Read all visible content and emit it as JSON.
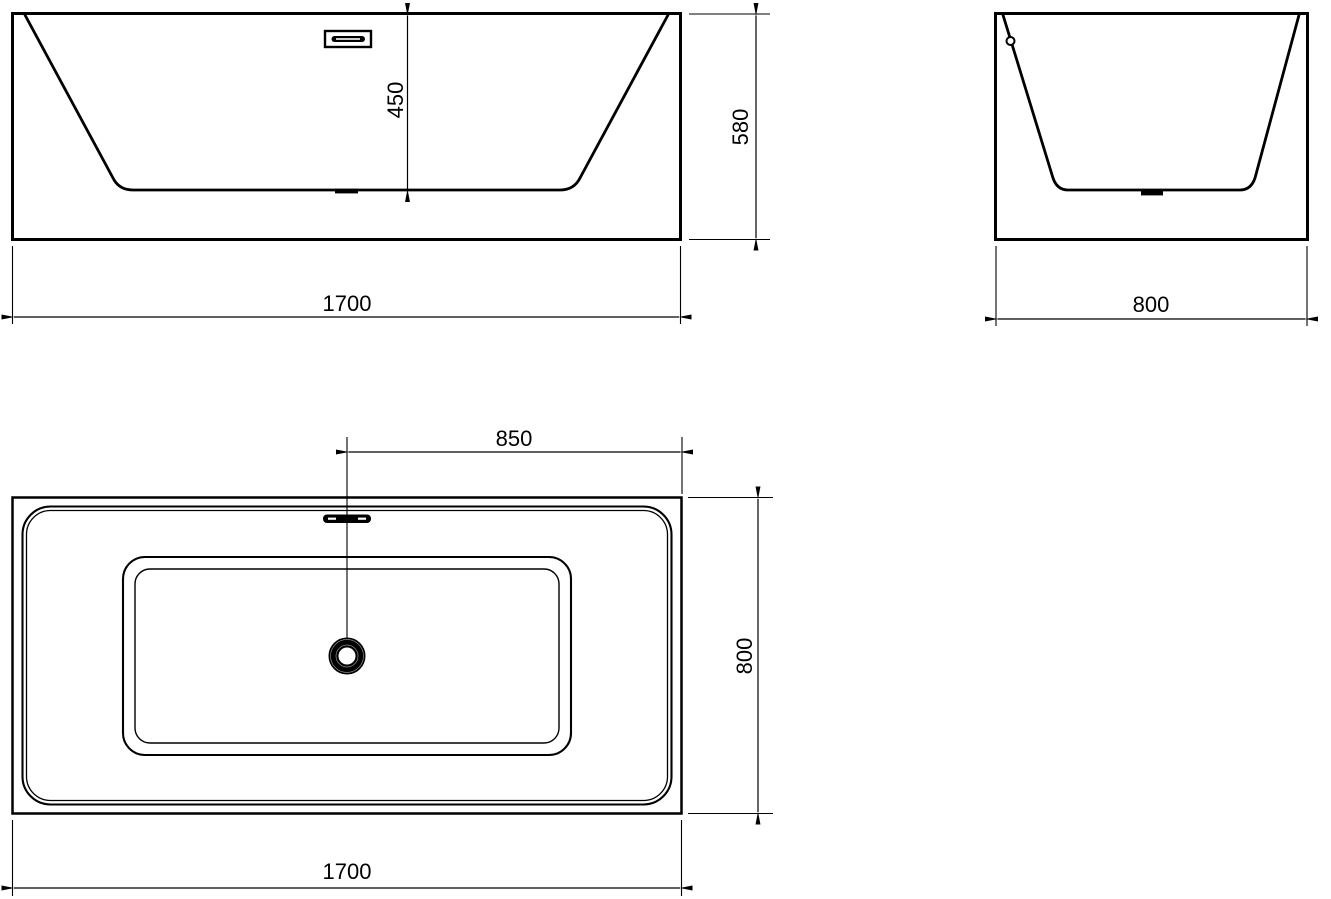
{
  "colors": {
    "line": "#000000",
    "background": "#ffffff"
  },
  "views": {
    "front": {
      "dim_inner_depth": "450",
      "dim_overall_height": "580",
      "dim_overall_length": "1700"
    },
    "side": {
      "dim_overall_width": "800"
    },
    "top": {
      "dim_drain_offset": "850",
      "dim_overall_width": "800",
      "dim_overall_length": "1700"
    }
  }
}
